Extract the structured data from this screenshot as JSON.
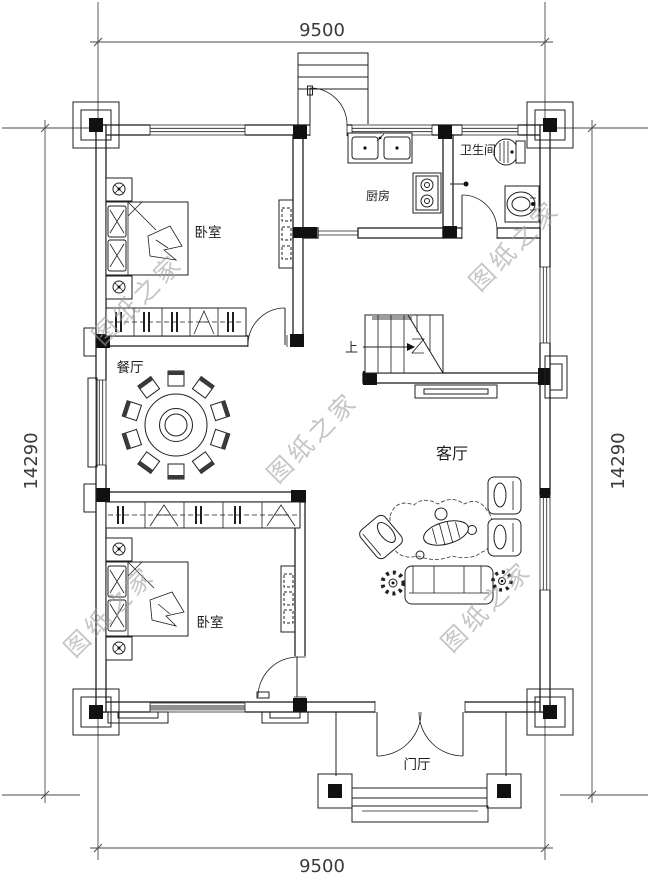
{
  "watermark": {
    "text": "图纸之家"
  },
  "dimensions": {
    "width_top": "9500",
    "width_bottom": "9500",
    "height_left": "14290",
    "height_right": "14290"
  },
  "rooms": {
    "bedroom_top": {
      "label": "卧室"
    },
    "kitchen": {
      "label": "厨房"
    },
    "bathroom": {
      "label": "卫生间"
    },
    "dining": {
      "label": "餐厅"
    },
    "living": {
      "label": "客厅"
    },
    "bedroom_bottom": {
      "label": "卧室"
    },
    "foyer": {
      "label": "门厅"
    }
  },
  "stairs": {
    "direction_label": "上"
  },
  "colors": {
    "line": "#1f1f1f",
    "watermark": "#9f9f9f",
    "window_shade": "#8f8f8f",
    "stair_band": "#9e9e9e"
  }
}
